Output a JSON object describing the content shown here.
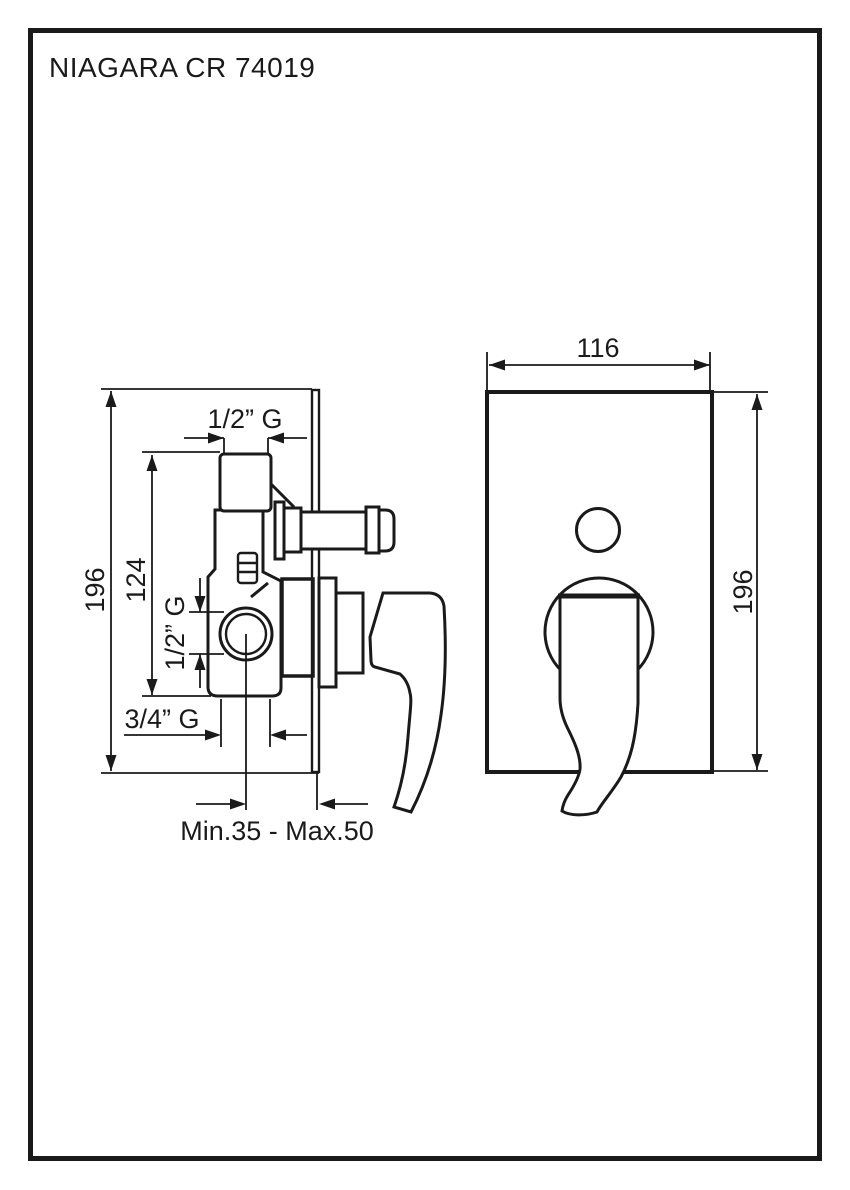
{
  "title": "NIAGARA CR 74019",
  "side_view": {
    "height_dim": "196",
    "body_height_dim": "124",
    "top_port_dim": "1/2” G",
    "side_port_dim": "1/2” G",
    "bottom_port_dim": "3/4” G",
    "depth_dim": "Min.35 - Max.50"
  },
  "front_view": {
    "width_dim": "116",
    "height_dim": "196"
  },
  "colors": {
    "line": "#1a1a1a",
    "paper": "#ffffff"
  }
}
